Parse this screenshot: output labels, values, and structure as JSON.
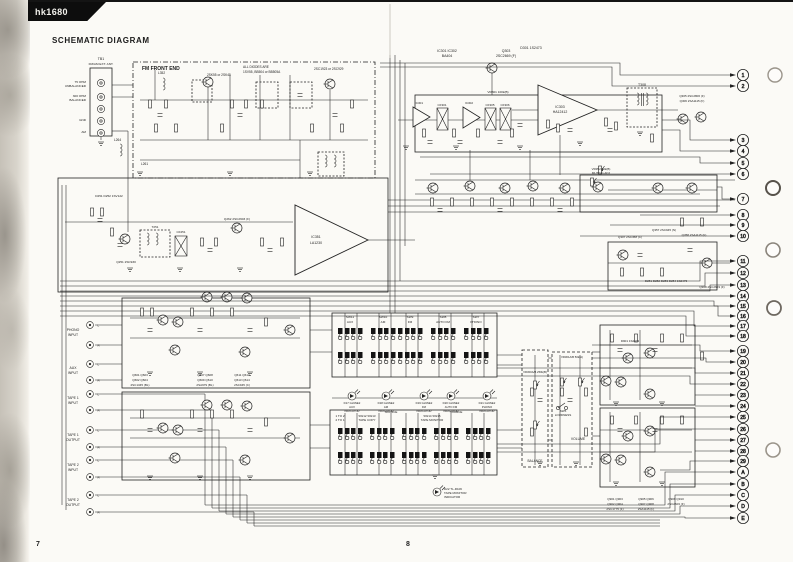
{
  "page": {
    "brand": "hk1680",
    "title": "SCHEMATIC DIAGRAM",
    "page_left": "7",
    "page_right": "8"
  },
  "antenna": {
    "ref": "TB1",
    "name": "FM/AM EXT. ANT.",
    "terminals": [
      {
        "l1": "75 OHM",
        "l2": "UNBALANCED"
      },
      {
        "l1": "300 OHM",
        "l2": "BALANCED"
      },
      {
        "l1": "",
        "l2": ""
      },
      {
        "l1": "GND",
        "l2": ""
      },
      {
        "l1": "AM",
        "l2": ""
      }
    ]
  },
  "front_end": {
    "label": "FM FRONT END",
    "fet_note": "2SK55 or 2SK45",
    "tr_note": "2SC1923 or 2SC929",
    "diode_note_1": "ALL DIODES ARE",
    "diode_note_2": "1SV55, BB504 or BB505A",
    "coil_1": "L352",
    "coil_2": "L264",
    "coil_3": "L261"
  },
  "if_section": {
    "heading_1": "IC301 IC302",
    "heading_2": "BA404",
    "ic1": "IC301",
    "ic2": "IC302",
    "q": "Q303",
    "q_part": "2SC2669 (F)",
    "d": "D301 1S2473",
    "vr": "VR301 100k(B)",
    "filters": [
      "CF301",
      "CF305",
      "CF306"
    ]
  },
  "mpx": {
    "ic_ref": "IC303",
    "ic_part": "HA12412",
    "transformer": "T308",
    "q_out_1": "Q305 2SC2806 (F)",
    "q_out_2": "Q306 2SA1115 (F)"
  },
  "fm_if": {
    "ic_ref": "IC351",
    "ic_part": "LA1230"
  },
  "am_section": {
    "diodes": "D251 D252 1SV122",
    "q1": "Q251 2SC930",
    "q2": "Q262 2SC2603 (F)",
    "filter": "CF251",
    "t1": "T251"
  },
  "detector": {
    "q1": "Q307 2SC458 (C)",
    "q2": "Q308 2SC2603 (F)",
    "q3": "Q357 2SC945 (N)",
    "q4": "Q358 2SA1115 (F)",
    "diodes": "D281 D282 D283 D284 1S2473",
    "muting_1": "VR352 50k(B)",
    "muting_2": "MUTING ADJ"
  },
  "preamp": {
    "groups": [
      {
        "l1": "Q601 Q603",
        "l2": "Q602 Q604",
        "l3": "2SC1345 (BL)"
      },
      {
        "l1": "Q607 Q608",
        "l2": "Q609 Q610",
        "l3": "2SA979 (BL)"
      },
      {
        "l1": "Q611 Q612",
        "l2": "Q613 Q614",
        "l3": "2SC945 (C)"
      }
    ]
  },
  "tone_amp": {
    "d": "D901 1S2473",
    "groups": [
      {
        "l1": "Q901 Q903",
        "l2": "Q902 Q904",
        "l3": "2SC1775 (F)"
      },
      {
        "l1": "Q905 Q906",
        "l2": "Q907 Q908",
        "l3": "2SA1115 (F)"
      },
      {
        "l1": "Q909 Q910",
        "l2": "2SC2603 (F)",
        "l3": ""
      }
    ]
  },
  "inputs": [
    {
      "n1": "PHONO",
      "n2": "INPUT",
      "l": "L",
      "r": "R"
    },
    {
      "n1": "AUX",
      "n2": "INPUT",
      "l": "L",
      "r": "R"
    },
    {
      "n1": "TAPE 1",
      "n2": "INPUT",
      "l": "L",
      "r": "R"
    },
    {
      "n1": "TAPE 1",
      "n2": "OUTPUT",
      "l": "L",
      "r": "R"
    },
    {
      "n1": "TAPE 2",
      "n2": "INPUT",
      "l": "L",
      "r": "R"
    },
    {
      "n1": "TAPE 2",
      "n2": "OUTPUT",
      "l": "L",
      "r": "R"
    }
  ],
  "switches": {
    "function": [
      {
        "ref": "SW11",
        "name": "AUX"
      },
      {
        "ref": "SW10",
        "name": "AM"
      },
      {
        "ref": "SW9",
        "name": "FM"
      },
      {
        "ref": "SW8",
        "name": "AUTO FM"
      },
      {
        "ref": "SW7",
        "name": "PHONO"
      }
    ],
    "tape_mark_1": "1 TO 2",
    "tape_mark_2": "2 TO 1",
    "copy_ref": "SW12 SW13",
    "copy_name": "TAPE COPY",
    "copy_source": "SOURCE",
    "monitor_ref": "SW14 SW15",
    "monitor_name": "TAPE MONITOR",
    "monitor_source": "SOURCE",
    "loudness_ref": "SW5",
    "loudness_name": "LOUDNESS"
  },
  "indicators": [
    {
      "ref": "D17 GL9NE2",
      "n1": "AUX",
      "n2": "INDICATOR"
    },
    {
      "ref": "D18 GL9NE2",
      "n1": "AM",
      "n2": "INDICATOR"
    },
    {
      "ref": "D19 GL9NE2",
      "n1": "FM",
      "n2": "INDICATOR"
    },
    {
      "ref": "D20 GL9NE2",
      "n1": "AUTO FM",
      "n2": "INDICATOR"
    },
    {
      "ref": "D21 GL9NE2",
      "n1": "PHONO",
      "n2": "INDICATOR"
    },
    {
      "ref": "D22 TL-R106",
      "n1": "TAPE MONITOR",
      "n2": "INDICATOR"
    }
  ],
  "controls": {
    "volume": "VOLUME",
    "balance": "BALANCE",
    "vr_volume": "VR301A/B 50k(A)",
    "vr_balance": "VR300A/B 250k(B)"
  },
  "connectors": {
    "numbers": [
      "1",
      "2",
      "3",
      "4",
      "5",
      "6",
      "7",
      "8",
      "9",
      "10",
      "11",
      "12",
      "13",
      "14",
      "15",
      "16",
      "17",
      "18",
      "19",
      "20",
      "21",
      "22",
      "23",
      "24",
      "25",
      "26",
      "27",
      "28",
      "29"
    ],
    "letters": [
      "A",
      "B",
      "C",
      "D",
      "E"
    ]
  }
}
